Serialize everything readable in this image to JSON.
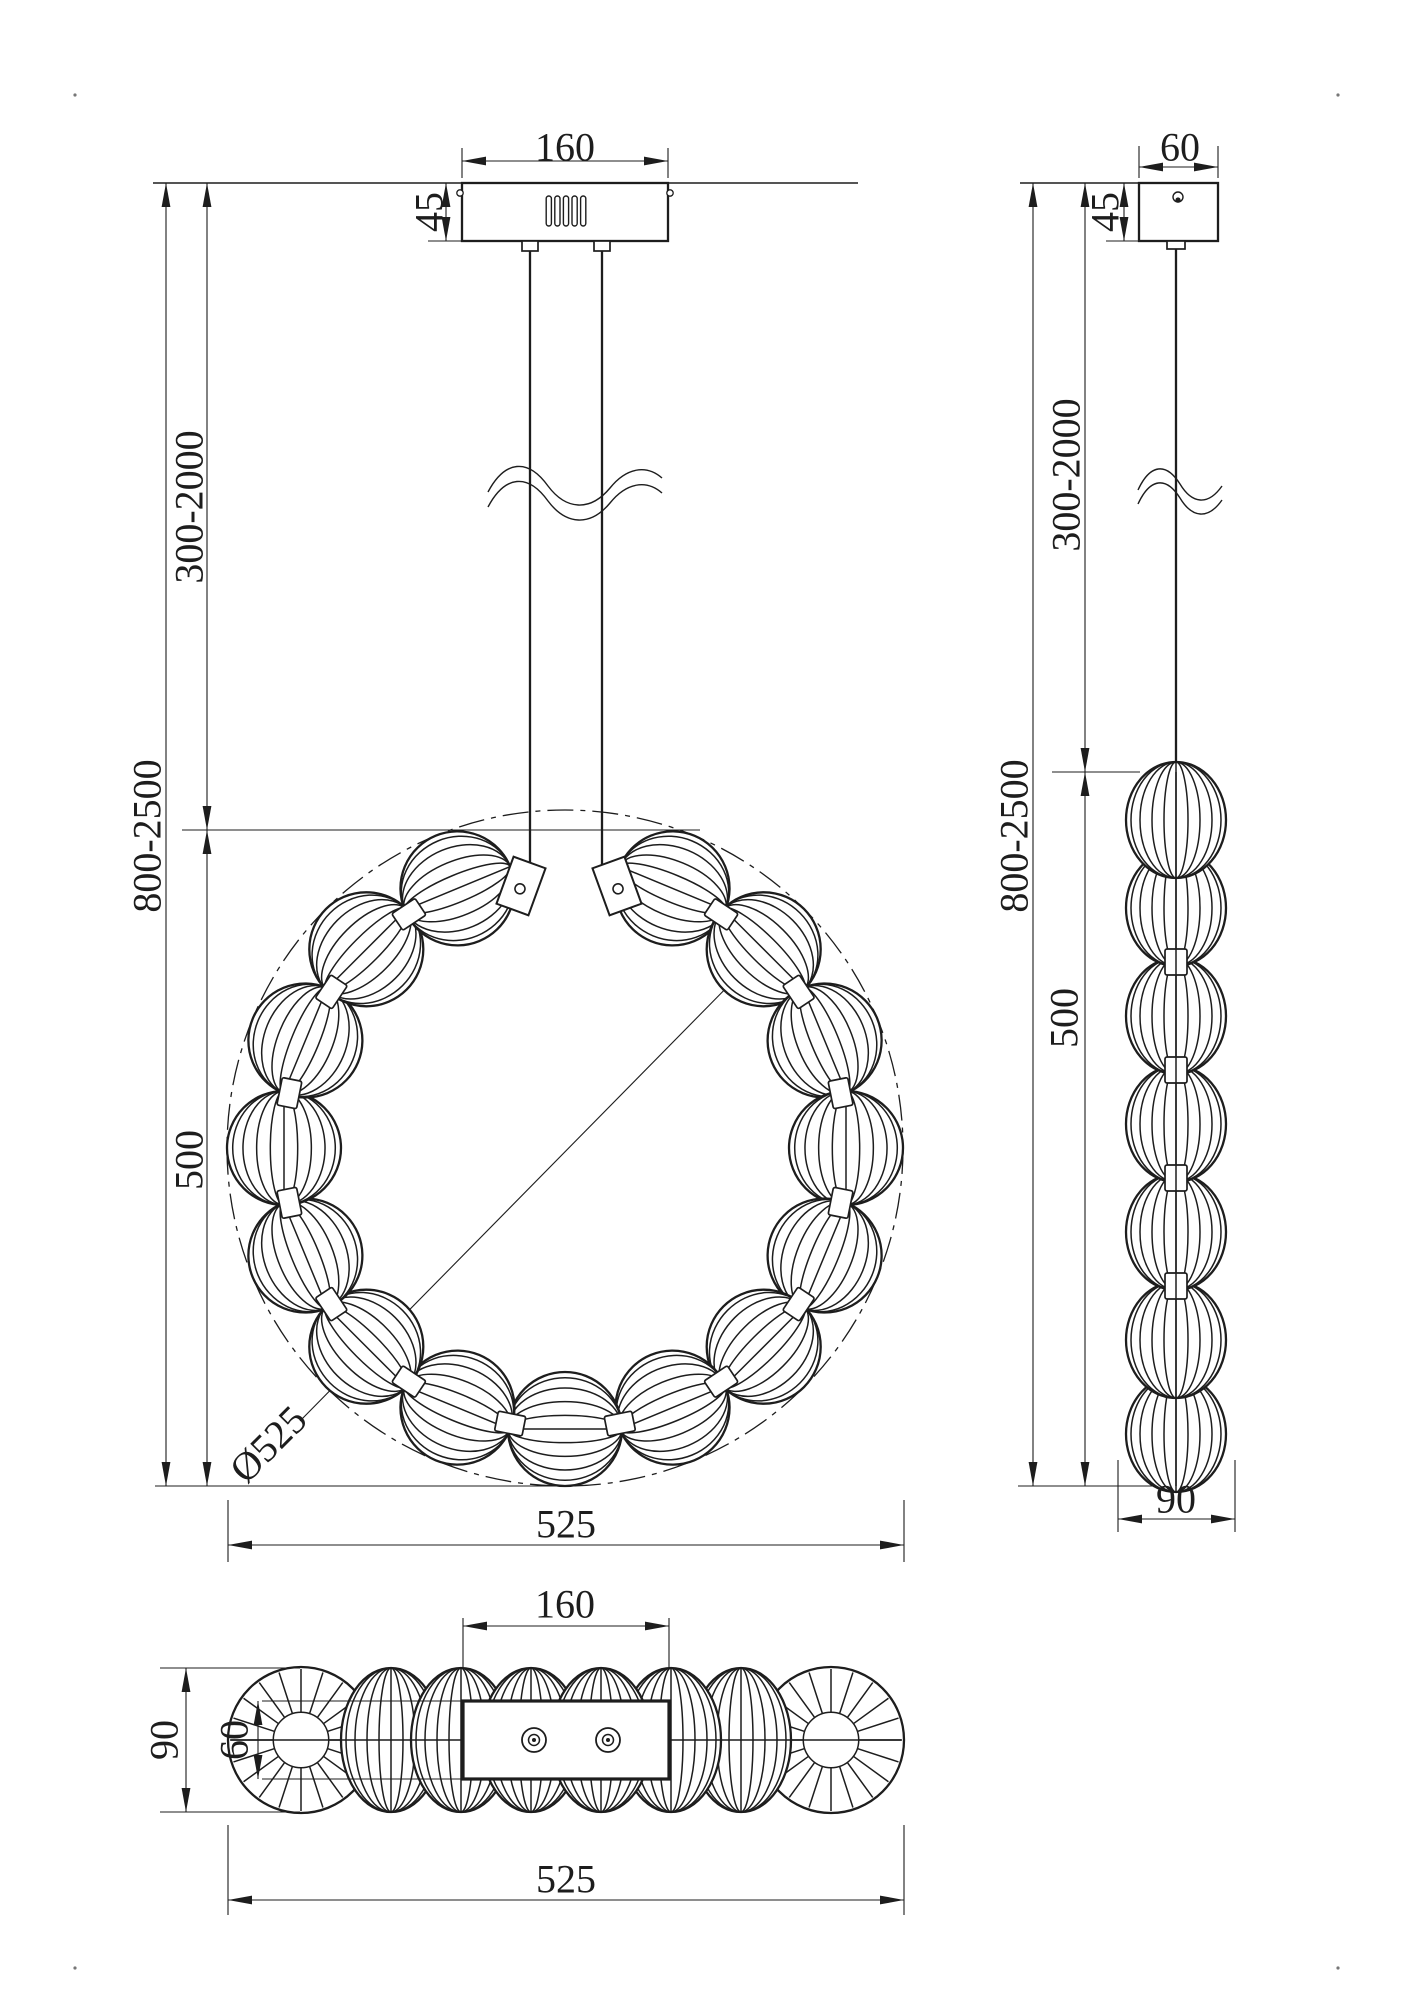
{
  "drawing": {
    "front": {
      "canopy_width": "160",
      "canopy_height": "45",
      "suspension_range": "300-2000",
      "overall_range": "800-2500",
      "body_height": "500",
      "body_diameter": "Ø525",
      "overall_width": "525"
    },
    "side": {
      "canopy_width": "60",
      "canopy_height": "45",
      "suspension_range": "300-2000",
      "overall_range": "800-2500",
      "body_height": "500",
      "body_width": "90"
    },
    "top": {
      "canopy_width": "160",
      "body_depth": "90",
      "plate_depth": "60",
      "overall_width": "525"
    },
    "colors": {
      "line_color": "#1d1d1d",
      "background": "#ffffff"
    }
  }
}
